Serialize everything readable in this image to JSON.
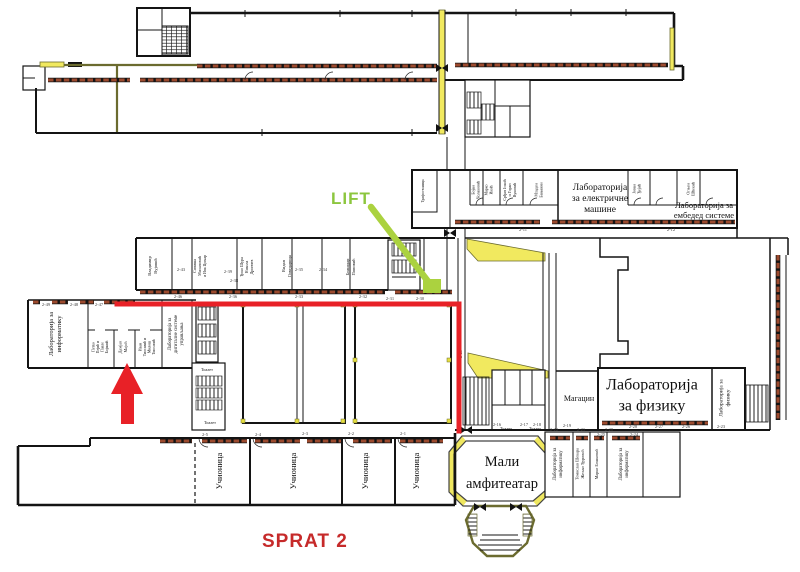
{
  "overlay": {
    "lift_label": "LIFT",
    "floor_label": "SPRAT 2"
  },
  "colors": {
    "wall": "#141414",
    "olive": "#6b6b2f",
    "yellow": "#f1e95f",
    "window": "#9c4a2e",
    "route": "#e82127",
    "lift_text": "#8cc63e",
    "lift_shape": "#abd23f",
    "floor_text": "#c62a2a"
  },
  "texts": {
    "laboratories": [
      {
        "name": "lab-electric-machines-label",
        "x": 600,
        "y": 201,
        "size": 9.5,
        "lh": 11,
        "lines": [
          "Лабораторија",
          "за електричне",
          "машине"
        ]
      },
      {
        "name": "lab-embedded-label",
        "x": 704,
        "y": 213,
        "size": 8.5,
        "lh": 10,
        "lines": [
          "Лабораторија за",
          "ембедед системе"
        ]
      },
      {
        "name": "lab-physics-label",
        "x": 652,
        "y": 400,
        "size": 16,
        "lh": 21,
        "lines": [
          "Лабораторија",
          "за физику"
        ]
      },
      {
        "name": "lab-physics-small-label",
        "x": 726,
        "y": 398,
        "size": 5.5,
        "lh": 7,
        "rotate": -90,
        "lines": [
          "Лабораторија за",
          "физику"
        ]
      },
      {
        "name": "lab-informatics-left-label",
        "x": 57,
        "y": 334,
        "size": 6.5,
        "lh": 8,
        "rotate": -90,
        "lines": [
          "Лабораторија за",
          "информатику"
        ]
      },
      {
        "name": "lab-digital-systems-label",
        "x": 177,
        "y": 334,
        "size": 4.8,
        "lh": 6,
        "rotate": -90,
        "lines": [
          "Лабораторија за",
          "дигиталне системе",
          "управљања"
        ]
      },
      {
        "name": "lab-informatics-br1-label",
        "x": 559,
        "y": 464,
        "size": 4.8,
        "lh": 6,
        "rotate": -90,
        "lines": [
          "Лабораторија за",
          "информатику"
        ]
      },
      {
        "name": "lab-informatics-br2-label",
        "x": 625,
        "y": 464,
        "size": 4.8,
        "lh": 6,
        "rotate": -90,
        "lines": [
          "Лабораторија за",
          "информатику"
        ]
      }
    ],
    "offices": [
      {
        "name": "office-label",
        "x": 154,
        "y": 266,
        "size": 4.5,
        "lh": 6,
        "rotate": -90,
        "lines": [
          "Владимир",
          "Вујовић"
        ]
      },
      {
        "name": "office-label",
        "x": 201,
        "y": 266,
        "size": 4,
        "lh": 5,
        "rotate": -90,
        "lines": [
          "Синиша",
          "Милановић",
          "и Ива Цоњар"
        ]
      },
      {
        "name": "office-label",
        "x": 248,
        "y": 267,
        "size": 4,
        "lh": 5,
        "rotate": -90,
        "lines": [
          "Ђоко Шура",
          "Никола",
          "Дринчев"
        ]
      },
      {
        "name": "office-label",
        "x": 288,
        "y": 266,
        "size": 4.5,
        "lh": 6,
        "rotate": -90,
        "lines": [
          "Видан",
          "Говедарица"
        ]
      },
      {
        "name": "office-label",
        "x": 352,
        "y": 267,
        "size": 4.5,
        "lh": 6,
        "rotate": -90,
        "lines": [
          "Божидар",
          "Поповић"
        ]
      },
      {
        "name": "office-label",
        "x": 424,
        "y": 191,
        "size": 3.8,
        "lh": 5,
        "rotate": -90,
        "lines": [
          "Трафостаница"
        ]
      },
      {
        "name": "office-label",
        "x": 477,
        "y": 190,
        "size": 4,
        "lh": 5,
        "rotate": -90,
        "lines": [
          "Бојан",
          "Чолаковић"
        ]
      },
      {
        "name": "office-label",
        "x": 490,
        "y": 190,
        "size": 4,
        "lh": 5,
        "rotate": -90,
        "lines": [
          "Марко",
          "Икић"
        ]
      },
      {
        "name": "office-label",
        "x": 511,
        "y": 190,
        "size": 4,
        "lh": 5,
        "rotate": -90,
        "lines": [
          "Срђан Јокић",
          "и Горан",
          "Вуковић"
        ]
      },
      {
        "name": "office-label",
        "x": 540,
        "y": 190,
        "size": 4,
        "lh": 5,
        "rotate": -90,
        "lines": [
          "Младен",
          "Бањанин"
        ]
      },
      {
        "name": "office-label",
        "x": 638,
        "y": 189,
        "size": 4,
        "lh": 5,
        "rotate": -90,
        "lines": [
          "Јован",
          "Ђејић"
        ]
      },
      {
        "name": "office-label",
        "x": 692,
        "y": 189,
        "size": 4,
        "lh": 5,
        "rotate": -90,
        "lines": [
          "Огњен",
          "Шћекић"
        ]
      },
      {
        "name": "office-label",
        "x": 101,
        "y": 347,
        "size": 3.8,
        "lh": 4.5,
        "rotate": -90,
        "lines": [
          "Петко",
          "Пејић и",
          "Павле",
          "Бојанић"
        ]
      },
      {
        "name": "office-label",
        "x": 124,
        "y": 347,
        "size": 4.2,
        "lh": 5.5,
        "rotate": -90,
        "lines": [
          "Дамјан",
          "Мајић"
        ]
      },
      {
        "name": "office-label",
        "x": 148,
        "y": 347,
        "size": 3.8,
        "lh": 4.5,
        "rotate": -90,
        "lines": [
          "Иван",
          "Тиосавић и",
          "Милош",
          "Тиосавић"
        ]
      },
      {
        "name": "office-label",
        "x": 581,
        "y": 464,
        "size": 4.2,
        "lh": 5.5,
        "rotate": -90,
        "lines": [
          "Томислав Шекара",
          "Жељко Ђуровић"
        ]
      },
      {
        "name": "office-label",
        "x": 598,
        "y": 464,
        "size": 4.2,
        "lh": 5.5,
        "rotate": -90,
        "lines": [
          "Марко Бошковић"
        ]
      }
    ],
    "facilities": [
      {
        "name": "small-amphitheater-label",
        "x": 502,
        "y": 477,
        "size": 14.5,
        "lh": 22,
        "lines": [
          "Мали",
          "амфитеатар"
        ]
      },
      {
        "name": "storage-label",
        "x": 579,
        "y": 401,
        "size": 8,
        "lh": 9,
        "lines": [
          "Магацин"
        ]
      },
      {
        "name": "toilet-label",
        "x": 207,
        "y": 371,
        "size": 4.2,
        "lh": 5,
        "lines": [
          "Тоалет"
        ]
      },
      {
        "name": "toilet-label",
        "x": 210,
        "y": 424,
        "size": 4.2,
        "lh": 5,
        "lines": [
          "Тоалет"
        ]
      },
      {
        "name": "toilet-label",
        "x": 506,
        "y": 430,
        "size": 4.2,
        "lh": 5,
        "lines": [
          "Тоалет"
        ]
      },
      {
        "name": "toilet-label",
        "x": 535,
        "y": 430,
        "size": 4.2,
        "lh": 5,
        "lines": [
          "Тоалет"
        ]
      }
    ],
    "classrooms": [
      {
        "name": "classroom-label",
        "x": 222,
        "y": 471,
        "size": 8.5,
        "lh": 9,
        "rotate": -90,
        "lines": [
          "Учионица"
        ]
      },
      {
        "name": "classroom-label",
        "x": 296,
        "y": 471,
        "size": 8.5,
        "lh": 9,
        "rotate": -90,
        "lines": [
          "Учионица"
        ]
      },
      {
        "name": "classroom-label",
        "x": 368,
        "y": 471,
        "size": 8.5,
        "lh": 9,
        "rotate": -90,
        "lines": [
          "Учионица"
        ]
      },
      {
        "name": "classroom-label",
        "x": 419,
        "y": 471,
        "size": 8.5,
        "lh": 9,
        "rotate": -90,
        "lines": [
          "Учионица"
        ]
      }
    ],
    "room_numbers": [
      {
        "name": "room-number",
        "cls": "num",
        "x": 46,
        "y": 306,
        "size": 4.5,
        "lines": [
          "2-49"
        ]
      },
      {
        "name": "room-number",
        "cls": "num",
        "x": 74,
        "y": 306,
        "size": 4.5,
        "lines": [
          "2-48"
        ]
      },
      {
        "name": "room-number",
        "cls": "num",
        "x": 99,
        "y": 306,
        "size": 4.5,
        "lines": [
          "2-47"
        ]
      },
      {
        "name": "room-number",
        "cls": "num",
        "x": 178,
        "y": 298,
        "size": 4.5,
        "lines": [
          "2-46"
        ]
      },
      {
        "name": "room-number",
        "cls": "num",
        "x": 233,
        "y": 298,
        "size": 4.5,
        "lines": [
          "2-36"
        ]
      },
      {
        "name": "room-number",
        "cls": "num",
        "x": 299,
        "y": 298,
        "size": 4.5,
        "lines": [
          "2-33"
        ]
      },
      {
        "name": "room-number",
        "cls": "num",
        "x": 363,
        "y": 298,
        "size": 4.5,
        "lines": [
          "2-32"
        ]
      },
      {
        "name": "room-number",
        "cls": "num",
        "x": 390,
        "y": 300,
        "size": 4.5,
        "lines": [
          "2-31"
        ]
      },
      {
        "name": "room-number",
        "cls": "num",
        "x": 420,
        "y": 300,
        "size": 4.5,
        "lines": [
          "2-30"
        ]
      },
      {
        "name": "room-number",
        "cls": "num",
        "x": 181,
        "y": 271,
        "size": 4.5,
        "lines": [
          "2-43"
        ]
      },
      {
        "name": "room-number",
        "cls": "num",
        "x": 228,
        "y": 273,
        "size": 4.5,
        "lines": [
          "2-39"
        ]
      },
      {
        "name": "room-number",
        "cls": "num",
        "x": 234,
        "y": 282,
        "size": 4.5,
        "lines": [
          "2-38"
        ]
      },
      {
        "name": "room-number",
        "cls": "num",
        "x": 299,
        "y": 271,
        "size": 4.5,
        "lines": [
          "2-35"
        ]
      },
      {
        "name": "room-number",
        "cls": "num",
        "x": 323,
        "y": 271,
        "size": 4.5,
        "lines": [
          "2-34"
        ]
      },
      {
        "name": "room-number",
        "cls": "num",
        "x": 523,
        "y": 231,
        "size": 4.5,
        "lines": [
          "2-11"
        ]
      },
      {
        "name": "room-number",
        "cls": "num",
        "x": 671,
        "y": 231,
        "size": 4.5,
        "lines": [
          "2-12"
        ]
      },
      {
        "name": "room-number",
        "cls": "num",
        "x": 462,
        "y": 354,
        "size": 4.5,
        "rotate": -90,
        "lines": [
          "2-29"
        ]
      },
      {
        "name": "room-number",
        "cls": "num",
        "x": 497,
        "y": 426,
        "size": 4.5,
        "lines": [
          "2-16"
        ]
      },
      {
        "name": "room-number",
        "cls": "num",
        "x": 524,
        "y": 426,
        "size": 4.5,
        "lines": [
          "2-17"
        ]
      },
      {
        "name": "room-number",
        "cls": "num",
        "x": 537,
        "y": 426,
        "size": 4.5,
        "lines": [
          "2-18"
        ]
      },
      {
        "name": "room-number",
        "cls": "num",
        "x": 567,
        "y": 427,
        "size": 4.5,
        "lines": [
          "2-19"
        ]
      },
      {
        "name": "room-number",
        "cls": "num",
        "x": 633,
        "y": 428,
        "size": 4.5,
        "lines": [
          "2-28"
        ]
      },
      {
        "name": "room-number",
        "cls": "num",
        "x": 659,
        "y": 428,
        "size": 4.5,
        "lines": [
          "2-27"
        ]
      },
      {
        "name": "room-number",
        "cls": "num",
        "x": 686,
        "y": 428,
        "size": 4.5,
        "lines": [
          "2-26"
        ]
      },
      {
        "name": "room-number",
        "cls": "num",
        "x": 721,
        "y": 428,
        "size": 4.5,
        "lines": [
          "2-23"
        ]
      },
      {
        "name": "room-number",
        "cls": "num",
        "x": 601,
        "y": 436,
        "size": 4.5,
        "lines": [
          "2-25"
        ]
      },
      {
        "name": "room-number",
        "cls": "num",
        "x": 634,
        "y": 436,
        "size": 4.5,
        "lines": [
          "2-24"
        ]
      },
      {
        "name": "room-number",
        "cls": "num",
        "x": 554,
        "y": 431,
        "size": 4.5,
        "lines": [
          "2-22"
        ]
      },
      {
        "name": "room-number",
        "cls": "num",
        "x": 581,
        "y": 431,
        "size": 4.5,
        "lines": [
          "2-21"
        ]
      },
      {
        "name": "room-number",
        "cls": "num",
        "x": 609,
        "y": 431,
        "size": 4.5,
        "lines": [
          "2-20"
        ]
      },
      {
        "name": "room-number",
        "cls": "num",
        "x": 205,
        "y": 436,
        "size": 4.5,
        "lines": [
          "2-5"
        ]
      },
      {
        "name": "room-number",
        "cls": "num",
        "x": 258,
        "y": 436,
        "size": 4.5,
        "lines": [
          "2-4"
        ]
      },
      {
        "name": "room-number",
        "cls": "num",
        "x": 305,
        "y": 435,
        "size": 4.5,
        "lines": [
          "2-3"
        ]
      },
      {
        "name": "room-number",
        "cls": "num",
        "x": 351,
        "y": 435,
        "size": 4.5,
        "lines": [
          "2-2"
        ]
      },
      {
        "name": "room-number",
        "cls": "num",
        "x": 403,
        "y": 435,
        "size": 4.5,
        "lines": [
          "2-1"
        ]
      }
    ]
  }
}
